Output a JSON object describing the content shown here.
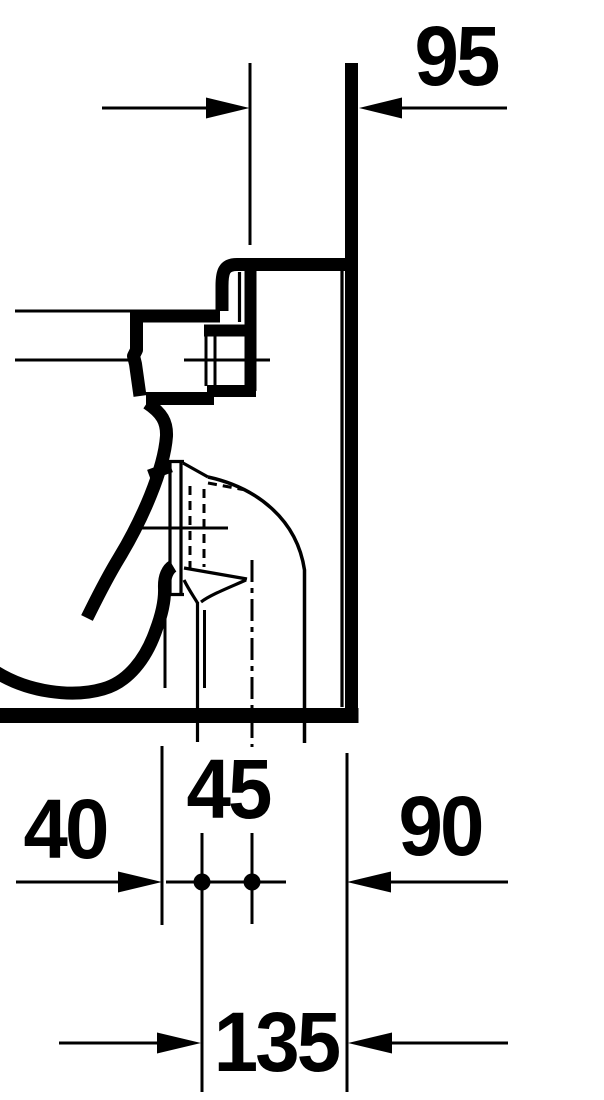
{
  "drawing": {
    "dimensions": {
      "d95": "95",
      "d40": "40",
      "d45": "45",
      "d90": "90",
      "d135": "135"
    },
    "colors": {
      "line": "#000000",
      "background": "#ffffff"
    }
  }
}
